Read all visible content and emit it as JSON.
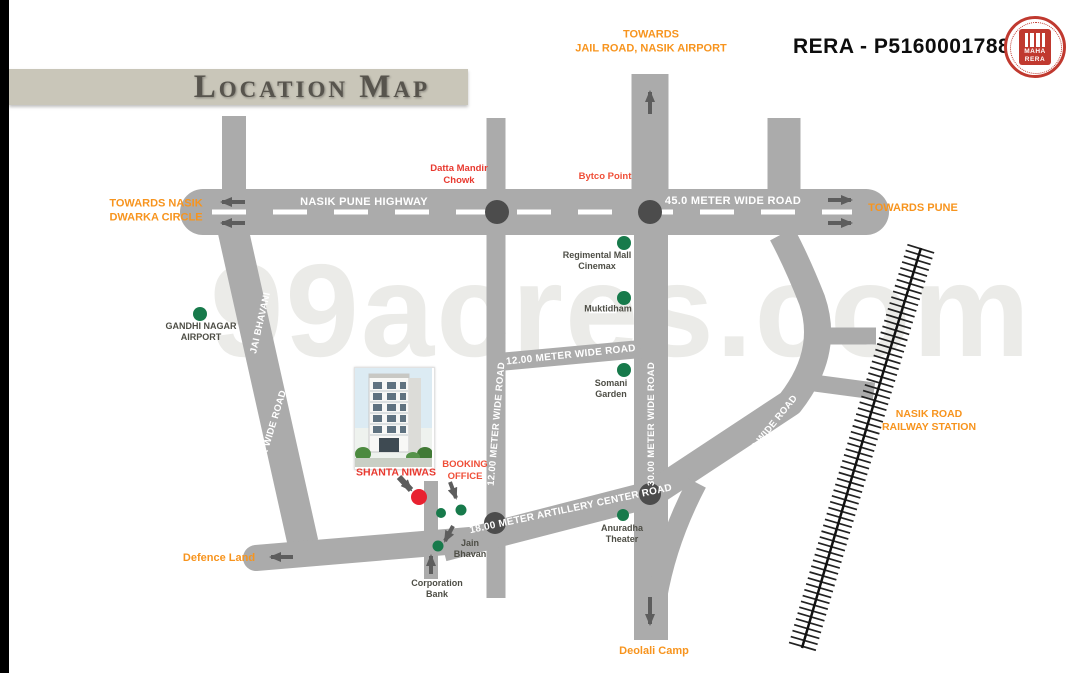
{
  "page": {
    "title_banner": "Location Map",
    "rera_number": "RERA - P51600017884",
    "logo": {
      "top": "MAHA",
      "bottom": "RERA"
    },
    "watermark": "99acres.com"
  },
  "directions": {
    "jail": "TOWARDS\nJAIL ROAD, NASIK AIRPORT",
    "dwarka": "TOWARDS NASIK\nDWARKA CIRCLE",
    "pune": "TOWARDS PUNE",
    "defence": "Defence Land",
    "deolali": "Deolali Camp",
    "railway_station": "NASIK ROAD\nRAILWAY STATION"
  },
  "roads": {
    "highway": "NASIK PUNE HIGHWAY",
    "r45": "45.0 METER WIDE ROAD",
    "r12_vertical": "12.00 METER WIDE ROAD",
    "r12_horizontal": "12.00 METER WIDE ROAD",
    "r30": "30.00 METER WIDE ROAD",
    "r18_left": "18.00 METER WIDE ROAD",
    "r18_right": "18.00 METER WIDE ROAD",
    "jai_bhavani": "JAI BHAVANI",
    "artillery": "18.00 METER ARTILLERY CENTER ROAD"
  },
  "landmarks": {
    "datta_mandir": "Datta Mandir\nChowk",
    "bytco_point": "Bytco Point",
    "regimental": "Regimental Mall\nCinemax",
    "muktidham": "Muktidham",
    "somani": "Somani\nGarden",
    "gandhi_nagar": "GANDHI NAGAR\nAIRPORT",
    "anuradha": "Anuradha\nTheater",
    "jain_bhavan": "Jain\nBhavan",
    "corporation_bank": "Corporation\nBank"
  },
  "project": {
    "name": "SHANTA NIWAS",
    "booking_office": "BOOKING\nOFFICE"
  },
  "colors": {
    "road_gray": "#ababab",
    "junction_dot": "#4c4c4c",
    "landmark_green": "#177a4b",
    "project_red": "#e82130",
    "accent_orange": "#f7941e",
    "accent_red": "#e8392f",
    "banner_beige": "#c9c6b9"
  }
}
